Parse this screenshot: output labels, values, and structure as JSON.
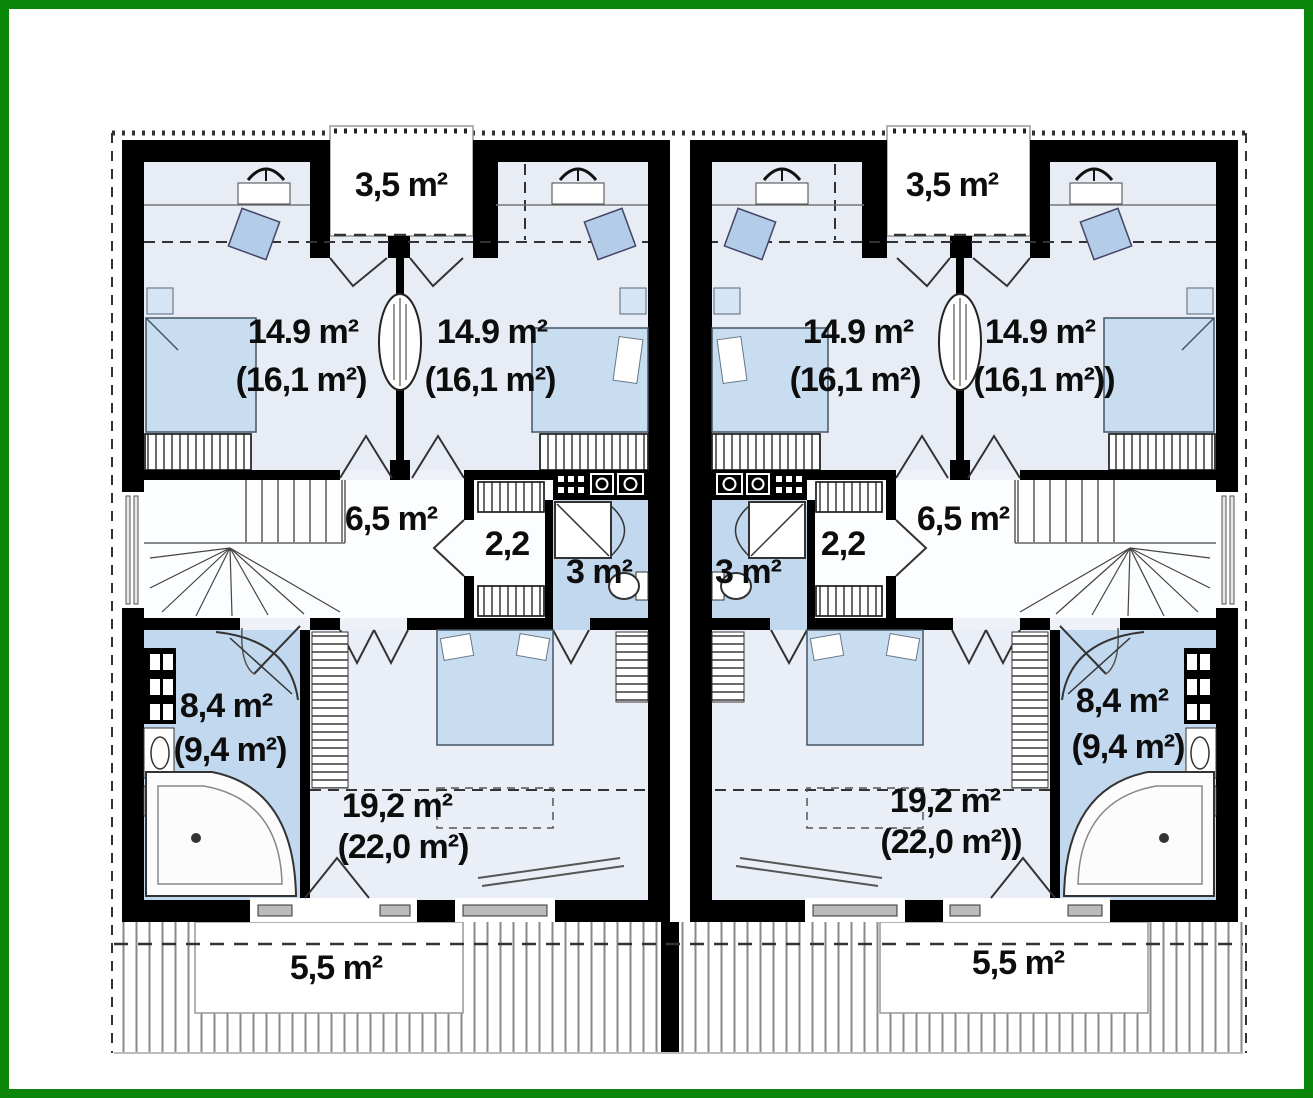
{
  "colors": {
    "frame_border": "#0a870a",
    "wall": "#000000",
    "bedroom_floor": "#e8edf5",
    "hall_floor": "#fbfdfe",
    "bathroom_floor": "#c2d8ee",
    "furniture_blue": "#c9ddf1",
    "deck_stripe": "#8a8a8a"
  },
  "plan": {
    "left_unit": {
      "balcony_area": "3,5 m²",
      "bedroom_left_area": "14.9 m²",
      "bedroom_left_area_attic": "(16,1 m²)",
      "bedroom_right_area": "14.9 m²",
      "bedroom_right_area_attic": "(16,1 m²)",
      "hall_area": "6,5 m²",
      "wardrobe_area": "2,2",
      "small_bathroom_area": "3 m²",
      "bathroom_area": "8,4 m²",
      "bathroom_area_attic": "(9,4 m²)",
      "main_bedroom_area": "19,2 m²",
      "main_bedroom_area_attic": "(22,0 m²)",
      "terrace_area": "5,5 m²"
    },
    "right_unit": {
      "balcony_area": "3,5 m²",
      "bedroom_left_area": "14.9 m²",
      "bedroom_left_area_attic": "(16,1 m²)",
      "bedroom_right_area": "14.9 m²",
      "bedroom_right_area_attic": "(16,1 m²))",
      "hall_area": "6,5 m²",
      "wardrobe_area": "2,2",
      "small_bathroom_area": "3 m²",
      "bathroom_area": "8,4 m²",
      "bathroom_area_attic": "(9,4 m²)",
      "main_bedroom_area": "19,2 m²",
      "main_bedroom_area_attic": "(22,0 m²))",
      "terrace_area": "5,5 m²"
    }
  }
}
